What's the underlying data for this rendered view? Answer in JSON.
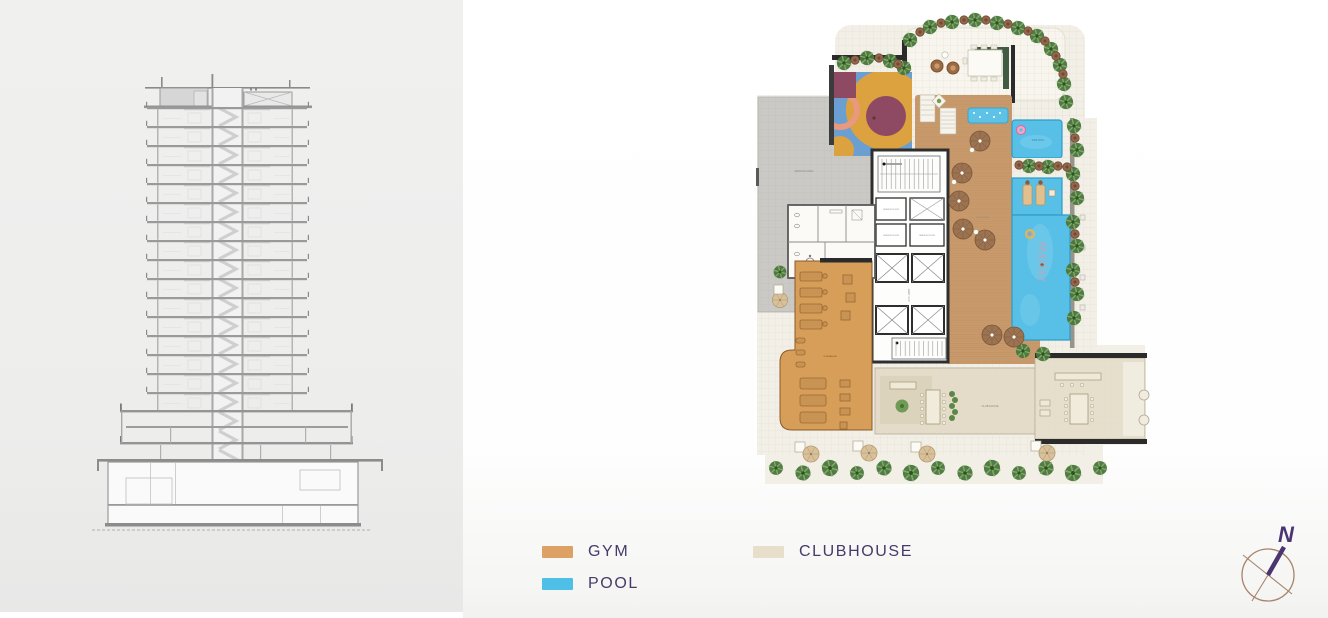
{
  "page": {
    "left_panel_bg": "#eeeeee",
    "right_panel_bg": "#ffffff"
  },
  "header": {
    "clipped_text": "BY MARINE"
  },
  "section_drawing": {
    "description": "building cross-section",
    "floors": 16,
    "line_color": "#9a9a9a",
    "stair_color": "#cfcfcf"
  },
  "plan": {
    "labels": {
      "service_area": "SERVICE AREA",
      "kids_pool": "KIDS POOL",
      "pool_deck": "POOL DECK",
      "gymnasium": "GYMNASIUM",
      "club_house": "CLUB HOUSE",
      "lift_lobby": "LIFT LOBBY",
      "service_room": "SERVICE ROOM",
      "watermark": "Matiaz"
    },
    "colors": {
      "gym": "#d79e59",
      "pool": "#57bfe6",
      "clubhouse": "#e4dcc9",
      "deck": "#c8996b",
      "service_terrace": "#cac9c5"
    }
  },
  "legend": {
    "items": [
      {
        "id": "gym",
        "label": "GYM",
        "color": "#dda165"
      },
      {
        "id": "pool",
        "label": "POOL",
        "color": "#4ec0e8"
      },
      {
        "id": "clubhouse",
        "label": "CLUBHOUSE",
        "color": "#e7decb"
      }
    ],
    "text_color": "#473a69"
  },
  "compass": {
    "label": "N"
  }
}
